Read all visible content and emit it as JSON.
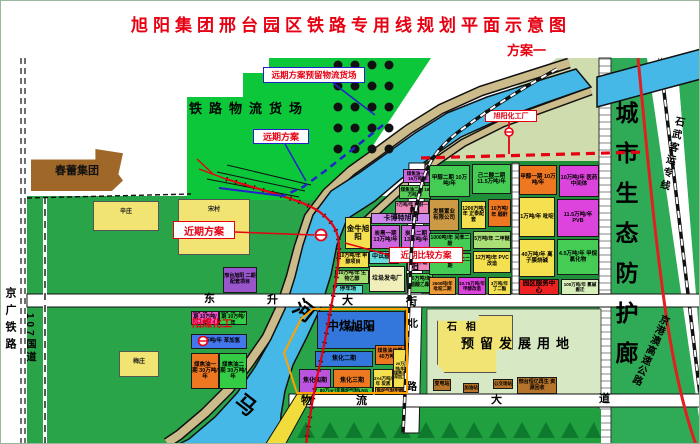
{
  "title": {
    "text": "旭阳集团邢台园区铁路专用线规划平面示意图",
    "scheme": "方案一"
  },
  "colors": {
    "title_red": "#e60012",
    "label_red": "#e60012",
    "label_blue": "#2222cc",
    "river_blue": "#45b8e8",
    "field_green": "#2aa449",
    "yard_green": "#0cc73a",
    "corridor_green": "#2fab57",
    "levee_tan": "#cdbc8b",
    "reserve_pale": "#d7e8c4",
    "village_yellow": "#f2e472",
    "rail_red": "#e60012",
    "tree_green": "#0d7a2e"
  },
  "map": {
    "callouts": [
      {
        "name": "callout-future-reserved-yard",
        "label": "远期方案预留物流货场",
        "x": 262,
        "y": 66,
        "w": 102,
        "h": 16,
        "fs": 8.5,
        "border": "blue"
      },
      {
        "name": "callout-future-scheme",
        "label": "远期方案",
        "x": 252,
        "y": 128,
        "w": 56,
        "h": 15,
        "fs": 9,
        "border": "blue"
      },
      {
        "name": "callout-near-term-scheme",
        "label": "近期方案",
        "x": 172,
        "y": 220,
        "w": 62,
        "h": 18,
        "fs": 10,
        "border": "red"
      },
      {
        "name": "callout-near-term-compare",
        "label": "近期比较方案",
        "x": 388,
        "y": 246,
        "w": 74,
        "h": 16,
        "fs": 8.5,
        "border": "red"
      },
      {
        "name": "callout-xuyang-chemical",
        "label": "旭阳化工厂",
        "x": 484,
        "y": 109,
        "w": 52,
        "h": 12,
        "fs": 7,
        "border": "red"
      }
    ],
    "villages": [
      {
        "name": "village-xinzhuang",
        "label": "辛庄",
        "x": 92,
        "y": 200,
        "w": 66,
        "h": 30
      },
      {
        "name": "village-songcun",
        "label": "宋村",
        "x": 177,
        "y": 198,
        "w": 72,
        "h": 56
      },
      {
        "name": "village-meizhuang",
        "label": "梅庄",
        "x": 118,
        "y": 350,
        "w": 40,
        "h": 26
      },
      {
        "name": "village-shixiang",
        "label": "",
        "x": 436,
        "y": 314,
        "w": 76,
        "h": 58,
        "clip": "polygon(0% 10%, 55% 10%, 55% 0%, 100% 0%, 100% 60%, 78% 60%, 78% 100%, 10% 100%, 0% 85%)"
      }
    ],
    "brown_blocks": [
      {
        "name": "chunlei-group-block",
        "label": "春蕾集团",
        "x": 30,
        "y": 148,
        "w": 92,
        "h": 42,
        "fs": 11,
        "clip": "polygon(0% 25%, 70% 25%, 70% 0%, 100% 10%, 95% 60%, 100% 75%, 88% 100%, 0% 100%)"
      }
    ],
    "parcels": [
      {
        "name": "parcel-jialu-gas-1",
        "label": "焦炉煤气一期 10万吨/年",
        "x": 190,
        "y": 310,
        "w": 28,
        "h": 14,
        "bg": "#ee55cc",
        "fs": 5
      },
      {
        "name": "parcel-jialu-gas-2",
        "label": "焦炉煤气二期 10万吨/年",
        "x": 218,
        "y": 310,
        "w": 28,
        "h": 14,
        "bg": "#33cc44",
        "fs": 5
      },
      {
        "name": "parcel-benzene",
        "label": "10万吨/年 苯加氢",
        "x": 190,
        "y": 333,
        "w": 56,
        "h": 15,
        "bg": "#4477ee",
        "fs": 5.5
      },
      {
        "name": "parcel-coal-tar-1",
        "label": "煤焦油一期 30万吨/年",
        "x": 190,
        "y": 352,
        "w": 28,
        "h": 36,
        "bg": "#ee7722",
        "fs": 5.5
      },
      {
        "name": "parcel-coal-tar-2",
        "label": "煤焦油二期 30万吨/年",
        "x": 218,
        "y": 352,
        "w": 28,
        "h": 36,
        "bg": "#33cc44",
        "fs": 5.5
      },
      {
        "name": "parcel-xingtai-phase2",
        "label": "邢台旭阳 二期配套项目",
        "x": 222,
        "y": 266,
        "w": 34,
        "h": 26,
        "bg": "#9955cc",
        "fs": 5
      },
      {
        "name": "parcel-jinniu-xuyang",
        "label": "金牛旭阳",
        "x": 344,
        "y": 216,
        "w": 26,
        "h": 32,
        "bg": "#f5e050",
        "fs": 7.5
      },
      {
        "name": "parcel-cabot-xuyang",
        "label": "卡博特旭阳",
        "x": 370,
        "y": 212,
        "w": 60,
        "h": 11,
        "bg": "#cc88ee",
        "fs": 7
      },
      {
        "name": "parcel-carbon-black-1",
        "label": "炭黑一期 13万吨/年",
        "x": 370,
        "y": 224,
        "w": 29,
        "h": 24,
        "bg": "#cc66e0",
        "fs": 5.5
      },
      {
        "name": "parcel-carbon-black-2",
        "label": "炭黑二期 13万吨/年",
        "x": 400,
        "y": 224,
        "w": 30,
        "h": 24,
        "bg": "#cc66e0",
        "fs": 5.5
      },
      {
        "name": "parcel-methanol-project",
        "label": "10万吨/年 甲醇项目",
        "x": 336,
        "y": 251,
        "w": 32,
        "h": 16,
        "bg": "#f5e050",
        "fs": 5
      },
      {
        "name": "parcel-pilot-base",
        "label": "中试基地",
        "x": 368,
        "y": 250,
        "w": 30,
        "h": 13,
        "bg": "#66dddd",
        "fs": 6
      },
      {
        "name": "parcel-bio-ethanol",
        "label": "10万吨/年 生物乙醇",
        "x": 334,
        "y": 269,
        "w": 34,
        "h": 14,
        "bg": "#aade77",
        "fs": 5
      },
      {
        "name": "parcel-waste-power-plant",
        "label": "垃圾发电厂",
        "x": 368,
        "y": 265,
        "w": 36,
        "h": 26,
        "bg": "#f0eebb",
        "fs": 6
      },
      {
        "name": "parcel-pom",
        "label": "8万吨/年 聚甲醛",
        "x": 406,
        "y": 250,
        "w": 26,
        "h": 20,
        "bg": "#ee88bb",
        "fs": 5
      },
      {
        "name": "parcel-ethyl-acetate",
        "label": "10万吨/年 醋酸乙酯",
        "x": 406,
        "y": 272,
        "w": 26,
        "h": 20,
        "bg": "#55cc55",
        "fs": 5
      },
      {
        "name": "parcel-parking",
        "label": "停车场",
        "x": 332,
        "y": 284,
        "w": 30,
        "h": 9,
        "bg": "#66dddd",
        "fs": 5.5
      },
      {
        "name": "parcel-coal-tar-s1",
        "label": "煤焦油一期 16万吨/年",
        "x": 402,
        "y": 168,
        "w": 30,
        "h": 14,
        "bg": "#cc66e0",
        "fs": 4.5
      },
      {
        "name": "parcel-coal-tar-s2",
        "label": "煤焦油二期 16万吨/年",
        "x": 398,
        "y": 184,
        "w": 32,
        "h": 14,
        "bg": "#55cc55",
        "fs": 4.5
      },
      {
        "name": "parcel-maleic",
        "label": "7万吨/年 顺酐一期",
        "x": 394,
        "y": 200,
        "w": 34,
        "h": 13,
        "bg": "#ee88bb",
        "fs": 4.5
      },
      {
        "name": "parcel-coking-1",
        "label": "焦化一期",
        "x": 316,
        "y": 310,
        "w": 88,
        "h": 38,
        "bg": "#3377dd",
        "fs": 6
      },
      {
        "name": "parcel-coking-2",
        "label": "焦化二期",
        "x": 314,
        "y": 350,
        "w": 58,
        "h": 16,
        "bg": "#3377dd",
        "fs": 6
      },
      {
        "name": "parcel-coal-tar-3b",
        "label": "煤焦油三期 40万吨/年",
        "x": 374,
        "y": 344,
        "w": 30,
        "h": 20,
        "bg": "#ee7722",
        "fs": 5
      },
      {
        "name": "parcel-coking-4",
        "label": "焦化四期",
        "x": 298,
        "y": 368,
        "w": 32,
        "h": 24,
        "bg": "#bb55dd",
        "fs": 6
      },
      {
        "name": "parcel-coking-3",
        "label": "焦化三期",
        "x": 332,
        "y": 368,
        "w": 38,
        "h": 24,
        "bg": "#ee7722",
        "fs": 6
      },
      {
        "name": "parcel-carbon-black-24",
        "label": "2×4万吨/年 炭黑",
        "x": 372,
        "y": 368,
        "w": 20,
        "h": 24,
        "bg": "#f5e050",
        "fs": 4.5
      },
      {
        "name": "parcel-tar-deep",
        "label": "20万吨/年煤焦油深加工",
        "x": 392,
        "y": 348,
        "w": 14,
        "h": 44,
        "bg": "#f5e050",
        "fs": 4
      },
      {
        "name": "parcel-lng",
        "label": "80万m³/年焦炉气制LNG",
        "x": 314,
        "y": 386,
        "w": 58,
        "h": 8,
        "bg": "#44cc44",
        "fs": 4.5
      },
      {
        "name": "parcel-gas-methanol",
        "label": "焦炉气制甲醇",
        "x": 374,
        "y": 386,
        "w": 30,
        "h": 8,
        "bg": "#ee9933",
        "fs": 4.5
      },
      {
        "name": "parcel-a-methanol-2",
        "label": "甲醇二期 10万吨/年",
        "x": 428,
        "y": 164,
        "w": 41,
        "h": 32,
        "bg": "#44cc55",
        "fs": 5.5
      },
      {
        "name": "parcel-a-adipic-2",
        "label": "己二酸二期 11.5万吨/年",
        "x": 471,
        "y": 163,
        "w": 39,
        "h": 30,
        "bg": "#44cc55",
        "fs": 5.5
      },
      {
        "name": "parcel-a-dev-company",
        "label": "发展置业 有限公司",
        "x": 428,
        "y": 198,
        "w": 30,
        "h": 32,
        "bg": "#cc9944",
        "fs": 5.5
      },
      {
        "name": "parcel-a-zhengtai",
        "label": "1200万吨/年 正泰配套",
        "x": 460,
        "y": 200,
        "w": 25,
        "h": 28,
        "bg": "#f5e050",
        "fs": 5
      },
      {
        "name": "parcel-a-maleic",
        "label": "10万吨/年 顺酐",
        "x": 487,
        "y": 198,
        "w": 23,
        "h": 28,
        "bg": "#ee7722",
        "fs": 5
      },
      {
        "name": "parcel-a-resorcinol",
        "label": "1000吨/年 间苯二酚",
        "x": 428,
        "y": 232,
        "w": 42,
        "h": 18,
        "bg": "#44cc55",
        "fs": 5
      },
      {
        "name": "parcel-a-dme",
        "label": "5万吨/年 二甲醚",
        "x": 472,
        "y": 230,
        "w": 38,
        "h": 18,
        "bg": "#aade77",
        "fs": 5
      },
      {
        "name": "parcel-a-pvc2",
        "label": "4.5万吨/年 PVC二期",
        "x": 428,
        "y": 252,
        "w": 42,
        "h": 22,
        "bg": "#44cc55",
        "fs": 5
      },
      {
        "name": "parcel-a-pvc-retrofit",
        "label": "12万吨/年 PVC改造",
        "x": 472,
        "y": 250,
        "w": 38,
        "h": 22,
        "bg": "#f5e050",
        "fs": 5
      },
      {
        "name": "parcel-a-pyridine2",
        "label": "2600吨/年 吡啶二期",
        "x": 428,
        "y": 276,
        "w": 27,
        "h": 18,
        "bg": "#ee9933",
        "fs": 4.5
      },
      {
        "name": "parcel-a-methanol-retrofit",
        "label": "10.75万吨/年 甲醇改造",
        "x": 457,
        "y": 276,
        "w": 28,
        "h": 18,
        "bg": "#dd44dd",
        "fs": 4.5
      },
      {
        "name": "parcel-a-succinate",
        "label": "3万吨/年 丁二酯",
        "x": 487,
        "y": 276,
        "w": 23,
        "h": 18,
        "bg": "#f5e050",
        "fs": 4.5
      },
      {
        "name": "parcel-b-methanol-1",
        "label": "甲醇一期 10万吨/年",
        "x": 518,
        "y": 164,
        "w": 38,
        "h": 30,
        "bg": "#ee7722",
        "fs": 5.5
      },
      {
        "name": "parcel-b-pharma",
        "label": "10万吨/年 医药中间体",
        "x": 558,
        "y": 164,
        "w": 40,
        "h": 32,
        "bg": "#dd44dd",
        "fs": 5.5
      },
      {
        "name": "parcel-b-pyridine",
        "label": "1万吨/年 吡啶",
        "x": 518,
        "y": 196,
        "w": 36,
        "h": 40,
        "bg": "#f5e050",
        "fs": 5.5
      },
      {
        "name": "parcel-b-pvb",
        "label": "11.5万吨/年 PVB",
        "x": 556,
        "y": 198,
        "w": 42,
        "h": 38,
        "bg": "#dd44dd",
        "fs": 5.5
      },
      {
        "name": "parcel-b-caustic",
        "label": "40万吨/年 离子膜烧碱",
        "x": 518,
        "y": 238,
        "w": 36,
        "h": 38,
        "bg": "#f5e050",
        "fs": 5.5
      },
      {
        "name": "parcel-b-methane-chloride",
        "label": "4.5万吨/年 甲烷氯化物",
        "x": 556,
        "y": 238,
        "w": 42,
        "h": 36,
        "bg": "#44cc55",
        "fs": 5.5
      },
      {
        "name": "parcel-service-center",
        "label": "园区服务中心",
        "x": 518,
        "y": 278,
        "w": 40,
        "h": 16,
        "bg": "#ee2222",
        "fs": 6.5
      },
      {
        "name": "parcel-chlor-alkali",
        "label": "100万吨/年 氯碱搬迁",
        "x": 560,
        "y": 278,
        "w": 38,
        "h": 16,
        "bg": "#d8eebb",
        "fs": 4.5
      },
      {
        "name": "parcel-hengyi-recycle",
        "label": "邢台恒亿再生 资源回收",
        "x": 516,
        "y": 376,
        "w": 40,
        "h": 17,
        "bg": "#b5742a",
        "fs": 5
      },
      {
        "name": "parcel-substation",
        "label": "变电站",
        "x": 432,
        "y": 378,
        "w": 18,
        "h": 12,
        "bg": "#b5742a",
        "fs": 5
      },
      {
        "name": "parcel-gas-station",
        "label": "加油站",
        "x": 462,
        "y": 382,
        "w": 16,
        "h": 10,
        "bg": "#b5742a",
        "fs": 4.5
      },
      {
        "name": "parcel-bus-depot",
        "label": "公交场站",
        "x": 492,
        "y": 378,
        "w": 20,
        "h": 10,
        "bg": "#b5742a",
        "fs": 4.5
      }
    ],
    "texts": [
      {
        "name": "yard-title",
        "label": "铁路物流货场",
        "x": 188,
        "y": 101,
        "fs": 13,
        "ls": 7
      },
      {
        "name": "reserve-land-title",
        "label": "预留发展用地",
        "x": 460,
        "y": 336,
        "fs": 13,
        "ls": 6
      },
      {
        "name": "shixiang-label",
        "label": "石 相",
        "x": 446,
        "y": 322,
        "fs": 10,
        "ls": 3
      },
      {
        "name": "zhongmei-xuyang-label",
        "label": "中煤旭阳",
        "x": 326,
        "y": 319,
        "fs": 12
      },
      {
        "name": "yangmei-chemical-label",
        "label": "阳煤化工",
        "x": 191,
        "y": 319,
        "fs": 10,
        "color": "#e60012"
      },
      {
        "name": "road-dongsheng-char1",
        "label": "东",
        "x": 203,
        "y": 293,
        "fs": 11
      },
      {
        "name": "road-dongsheng-char2",
        "label": "升",
        "x": 266,
        "y": 294,
        "fs": 11
      },
      {
        "name": "road-dongsheng-char3",
        "label": "大",
        "x": 341,
        "y": 295,
        "fs": 11
      },
      {
        "name": "road-dongsheng-char4",
        "label": "街",
        "x": 405,
        "y": 296,
        "fs": 11
      },
      {
        "name": "road-wuliu-char1",
        "label": "物",
        "x": 300,
        "y": 395,
        "fs": 11
      },
      {
        "name": "road-wuliu-char2",
        "label": "流",
        "x": 355,
        "y": 395,
        "fs": 11
      },
      {
        "name": "road-wuliu-char3",
        "label": "大",
        "x": 490,
        "y": 394,
        "fs": 11
      },
      {
        "name": "road-wuliu-char4",
        "label": "道",
        "x": 598,
        "y": 393,
        "fs": 11
      },
      {
        "name": "road-xuyang-north-char1",
        "label": "旭",
        "x": 409,
        "y": 206,
        "fs": 10
      },
      {
        "name": "road-xuyang-north-char2",
        "label": "阳",
        "x": 408,
        "y": 262,
        "fs": 10
      },
      {
        "name": "road-xuyang-north-char3",
        "label": "北",
        "x": 407,
        "y": 319,
        "fs": 10
      },
      {
        "name": "road-xuyang-north-char4",
        "label": "路",
        "x": 406,
        "y": 382,
        "fs": 10
      },
      {
        "name": "river-name-char-he",
        "label": "河",
        "x": 292,
        "y": 300,
        "fs": 21,
        "rot": 38
      },
      {
        "name": "river-name-char-ma",
        "label": "马",
        "x": 234,
        "y": 394,
        "fs": 21,
        "rot": 38
      },
      {
        "name": "eco-corridor-title",
        "label": "城市生态防护廊",
        "x": 612,
        "y": 100,
        "fs": 23,
        "ls": 17,
        "vert": true
      },
      {
        "name": "jingguang-railway-label",
        "label": "京广铁路",
        "x": 3,
        "y": 286,
        "fs": 11,
        "ls": 6,
        "vert": true
      },
      {
        "name": "g107-label",
        "label": "107国道",
        "x": 23,
        "y": 312,
        "fs": 10,
        "ls": 3,
        "vert": true
      },
      {
        "name": "shiwu-hsr-label",
        "label": "石武客运专线",
        "x": 664,
        "y": 114,
        "fs": 10,
        "ls": 3,
        "vert": true,
        "rot": 13
      },
      {
        "name": "jinggangao-expressway-label",
        "label": "京港澳高速公路",
        "x": 643,
        "y": 310,
        "fs": 10,
        "ls": 1,
        "vert": true,
        "rot": 24
      }
    ],
    "dots": {
      "x0": 337,
      "y0": 64,
      "dx": 17,
      "dy": 21,
      "cols": 4,
      "rows": 5,
      "r": 4.5
    }
  }
}
